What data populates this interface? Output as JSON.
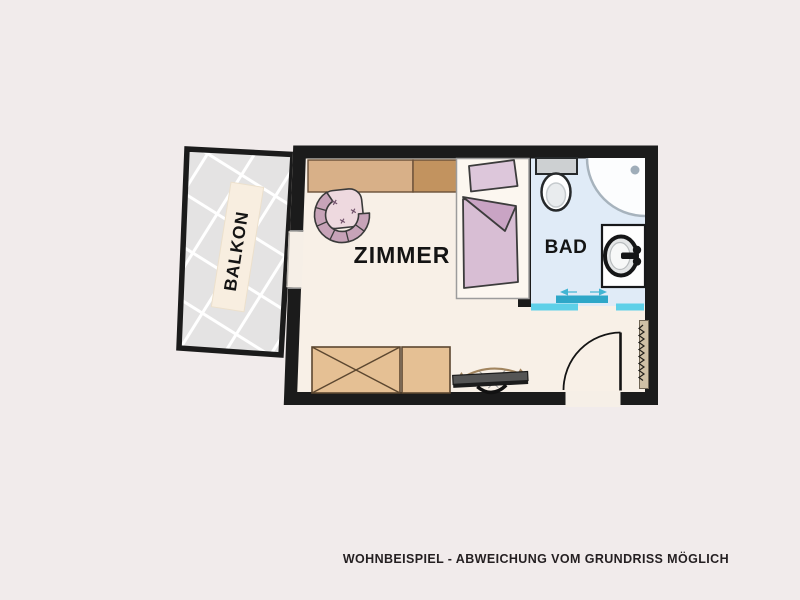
{
  "page": {
    "background": "#f1ebeb",
    "caption": "WOHNBEISPIEL - ABWEICHUNG VOM GRUNDRISS MÖGLICH"
  },
  "floorplan": {
    "rooms": {
      "balcony": {
        "label": "BALKON"
      },
      "room": {
        "label": "ZIMMER"
      },
      "bath": {
        "label": "BAD"
      }
    },
    "colors": {
      "wall": "#1b1b1b",
      "room_floor": "#f8f0e7",
      "bath_floor": "#e0ebf7",
      "balcony_tiles": "#e4e3e3",
      "tile_grout": "#ffffff",
      "sliding_panel": "#2ea7c8",
      "sliding_rail": "#5ed0e8",
      "wood_light": "#d8b088",
      "wood_dark": "#c2935f",
      "sideboard_wood": "#e5c094",
      "bedding_pink": "#d8bed4",
      "bedding_fold": "#c9a4c4",
      "pillow_pink": "#ddc7db",
      "chair_seat": "#eed9df",
      "chair_rim": "#c7a3b8",
      "tv_gray": "#555555",
      "arrow_tan": "#a2855f"
    },
    "furniture": [
      {
        "name": "wardrobe"
      },
      {
        "name": "armchair"
      },
      {
        "name": "single-bed"
      },
      {
        "name": "sideboard"
      },
      {
        "name": "tv"
      },
      {
        "name": "radiator"
      },
      {
        "name": "entry-door"
      },
      {
        "name": "sliding-door"
      },
      {
        "name": "toilet"
      },
      {
        "name": "corner-shower"
      },
      {
        "name": "washing-machine"
      },
      {
        "name": "balcony-rug"
      }
    ]
  }
}
